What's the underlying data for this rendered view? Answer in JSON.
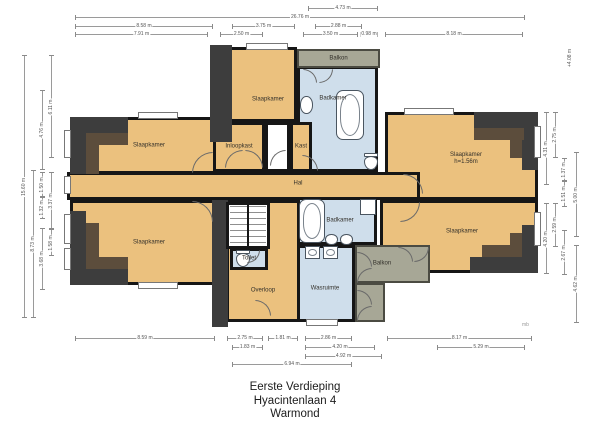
{
  "title": {
    "line1": "Eerste Verdieping",
    "line2": "Hyacintenlaan 4",
    "line3": "Warmond"
  },
  "watermark": "mb",
  "level_marker": {
    "label": "+4.08 m",
    "x": 570,
    "y": 58
  },
  "colors": {
    "floor_orange": "#ebc17e",
    "wet_room_blue": "#cfdeeb",
    "balcony_grey": "#a7a796",
    "wall_black": "#161616",
    "roof_zone_dark": "#3d3d3d",
    "roof_zone_brown": "#5c4d3c",
    "dimension_grey": "#9a9a9a"
  },
  "plan": {
    "rooms": [
      {
        "id": "bedroom-top-right",
        "label": "Slaapkamer",
        "sublabel": "h=1.56m",
        "type": "bedroom",
        "rect": [
          385,
          112,
          153,
          88
        ],
        "label_at": [
          466,
          159
        ]
      },
      {
        "id": "bedroom-bottom-right",
        "label": "Slaapkamer",
        "type": "bedroom",
        "rect": [
          380,
          200,
          158,
          73
        ],
        "label_at": [
          462,
          232
        ]
      },
      {
        "id": "bedroom-top-left",
        "label": "Slaapkamer",
        "type": "bedroom",
        "rect": [
          70,
          117,
          158,
          57
        ]
      },
      {
        "id": "bedroom-bottom-left",
        "label": "Slaapkamer",
        "type": "bedroom",
        "rect": [
          70,
          200,
          158,
          85
        ]
      },
      {
        "id": "bedroom-top-center",
        "label": "Slaapkamer",
        "type": "bedroom",
        "rect": [
          213,
          47,
          84,
          75
        ],
        "label_at": [
          268,
          100
        ]
      },
      {
        "id": "badkamer-top",
        "label": "Badkamer",
        "type": "wet",
        "rect": [
          297,
          66,
          81,
          106
        ],
        "label_at": [
          333,
          99
        ]
      },
      {
        "id": "balkon-top",
        "label": "Balkon",
        "type": "balcony",
        "rect": [
          297,
          49,
          83,
          19
        ]
      },
      {
        "id": "hal",
        "label": "Hal",
        "type": "hall",
        "rect": [
          67,
          172,
          353,
          28
        ],
        "label_at": [
          298,
          184
        ]
      },
      {
        "id": "closet-passage",
        "label": "",
        "type": "plain",
        "rect": [
          265,
          122,
          25,
          50
        ]
      },
      {
        "id": "inloopkast",
        "label": "Inloopkast",
        "type": "bedroom",
        "rect": [
          213,
          122,
          52,
          50
        ]
      },
      {
        "id": "kast",
        "label": "Kast",
        "type": "bedroom",
        "rect": [
          290,
          122,
          22,
          50
        ]
      },
      {
        "id": "overloop",
        "label": "Overloop",
        "type": "hall",
        "rect": [
          226,
          200,
          74,
          122
        ],
        "label_at": [
          263,
          291
        ]
      },
      {
        "id": "badkamer-bottom",
        "label": "Badkamer",
        "type": "wet",
        "rect": [
          297,
          197,
          80,
          48
        ],
        "label_at": [
          340,
          221
        ]
      },
      {
        "id": "wasruimte",
        "label": "Wasruimte",
        "type": "wet",
        "rect": [
          297,
          245,
          58,
          77
        ],
        "label_at": [
          325,
          289
        ]
      },
      {
        "id": "toilet",
        "label": "Toilet",
        "type": "wet",
        "rect": [
          230,
          248,
          38,
          22
        ]
      },
      {
        "id": "balkon-bottom",
        "label": "Balkon",
        "type": "balcony",
        "rect": [
          355,
          245,
          75,
          38
        ],
        "label_at": [
          382,
          264
        ]
      },
      {
        "id": "balkon-bottom-ext",
        "label": "",
        "type": "balcony",
        "rect": [
          355,
          283,
          30,
          39
        ]
      }
    ],
    "dims": [
      {
        "o": "h",
        "x": 308,
        "y": 8,
        "len": 70,
        "label": "4.73 m"
      },
      {
        "o": "h",
        "x": 75,
        "y": 17,
        "len": 450,
        "label": "26.76 m"
      },
      {
        "o": "h",
        "x": 75,
        "y": 26,
        "len": 138,
        "label": "8.58 m"
      },
      {
        "o": "h",
        "x": 232,
        "y": 26,
        "len": 63,
        "label": "3.75 m"
      },
      {
        "o": "h",
        "x": 315,
        "y": 26,
        "len": 47,
        "label": "2.88 m"
      },
      {
        "o": "h",
        "x": 75,
        "y": 34,
        "len": 133,
        "label": "7.91 m"
      },
      {
        "o": "h",
        "x": 220,
        "y": 34,
        "len": 43,
        "label": "2.50 m"
      },
      {
        "o": "h",
        "x": 303,
        "y": 34,
        "len": 55,
        "label": "3.50 m"
      },
      {
        "o": "h",
        "x": 360,
        "y": 34,
        "len": 18,
        "label": "0.98 m"
      },
      {
        "o": "h",
        "x": 385,
        "y": 34,
        "len": 138,
        "label": "8.18 m"
      },
      {
        "o": "h",
        "x": 75,
        "y": 338,
        "len": 140,
        "label": "8.59 m"
      },
      {
        "o": "h",
        "x": 227,
        "y": 338,
        "len": 36,
        "label": "2.75 m"
      },
      {
        "o": "h",
        "x": 268,
        "y": 338,
        "len": 30,
        "label": "1.81 m"
      },
      {
        "o": "h",
        "x": 305,
        "y": 338,
        "len": 47,
        "label": "2.86 m"
      },
      {
        "o": "h",
        "x": 387,
        "y": 338,
        "len": 145,
        "label": "8.17 m"
      },
      {
        "o": "h",
        "x": 232,
        "y": 347,
        "len": 31,
        "label": "1.83 m"
      },
      {
        "o": "h",
        "x": 305,
        "y": 347,
        "len": 70,
        "label": "4.20 m"
      },
      {
        "o": "h",
        "x": 437,
        "y": 347,
        "len": 88,
        "label": "5.29 m"
      },
      {
        "o": "h",
        "x": 305,
        "y": 356,
        "len": 77,
        "label": "4.92 m"
      },
      {
        "o": "h",
        "x": 232,
        "y": 364,
        "len": 120,
        "label": "6.94 m"
      },
      {
        "o": "v",
        "x": 24,
        "y": 55,
        "len": 263,
        "label": "15.60 m"
      },
      {
        "o": "v",
        "x": 33,
        "y": 170,
        "len": 148,
        "label": "8.73 m"
      },
      {
        "o": "v",
        "x": 42,
        "y": 90,
        "len": 80,
        "label": "4.76 m"
      },
      {
        "o": "v",
        "x": 42,
        "y": 172,
        "len": 25,
        "label": "1.50 m"
      },
      {
        "o": "v",
        "x": 42,
        "y": 197,
        "len": 22,
        "label": "1.32 m"
      },
      {
        "o": "v",
        "x": 42,
        "y": 228,
        "len": 62,
        "label": "3.68 m"
      },
      {
        "o": "v",
        "x": 51,
        "y": 55,
        "len": 103,
        "label": "6.11 m"
      },
      {
        "o": "v",
        "x": 51,
        "y": 172,
        "len": 57,
        "label": "3.37 m"
      },
      {
        "o": "v",
        "x": 51,
        "y": 229,
        "len": 27,
        "label": "1.58 m"
      },
      {
        "o": "v",
        "x": 546,
        "y": 112,
        "len": 73,
        "label": "4.31 m"
      },
      {
        "o": "v",
        "x": 555,
        "y": 112,
        "len": 46,
        "label": "2.75 m"
      },
      {
        "o": "v",
        "x": 564,
        "y": 158,
        "len": 23,
        "label": "1.37 m"
      },
      {
        "o": "v",
        "x": 564,
        "y": 181,
        "len": 26,
        "label": "1.51 m"
      },
      {
        "o": "v",
        "x": 576,
        "y": 152,
        "len": 85,
        "label": "5.00 m"
      },
      {
        "o": "v",
        "x": 546,
        "y": 203,
        "len": 71,
        "label": "4.20 m"
      },
      {
        "o": "v",
        "x": 555,
        "y": 203,
        "len": 44,
        "label": "2.59 m"
      },
      {
        "o": "v",
        "x": 564,
        "y": 230,
        "len": 45,
        "label": "2.67 m"
      },
      {
        "o": "v",
        "x": 576,
        "y": 245,
        "len": 78,
        "label": "4.62 m"
      }
    ]
  }
}
